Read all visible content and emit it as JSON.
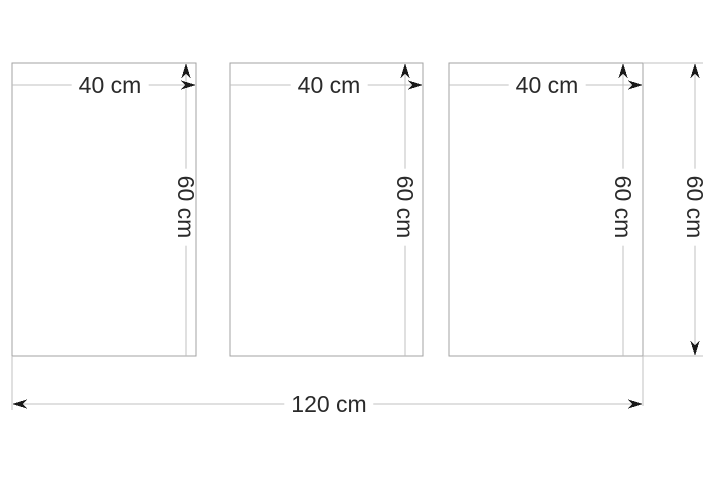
{
  "diagram_type": "triptych-panel-dimension-drawing",
  "panels": [
    {
      "width_label": "40 cm",
      "height_label": "60 cm"
    },
    {
      "width_label": "40 cm",
      "height_label": "60 cm"
    },
    {
      "width_label": "40 cm",
      "height_label": "60 cm"
    }
  ],
  "overall": {
    "width_label": "120 cm",
    "height_label": "60 cm"
  },
  "colors": {
    "background": "#ffffff",
    "panel_border": "#a3a3a3",
    "dimension_line": "#c0c0c0",
    "arrow": "#1a1a1a",
    "text": "#2a2a2a"
  }
}
